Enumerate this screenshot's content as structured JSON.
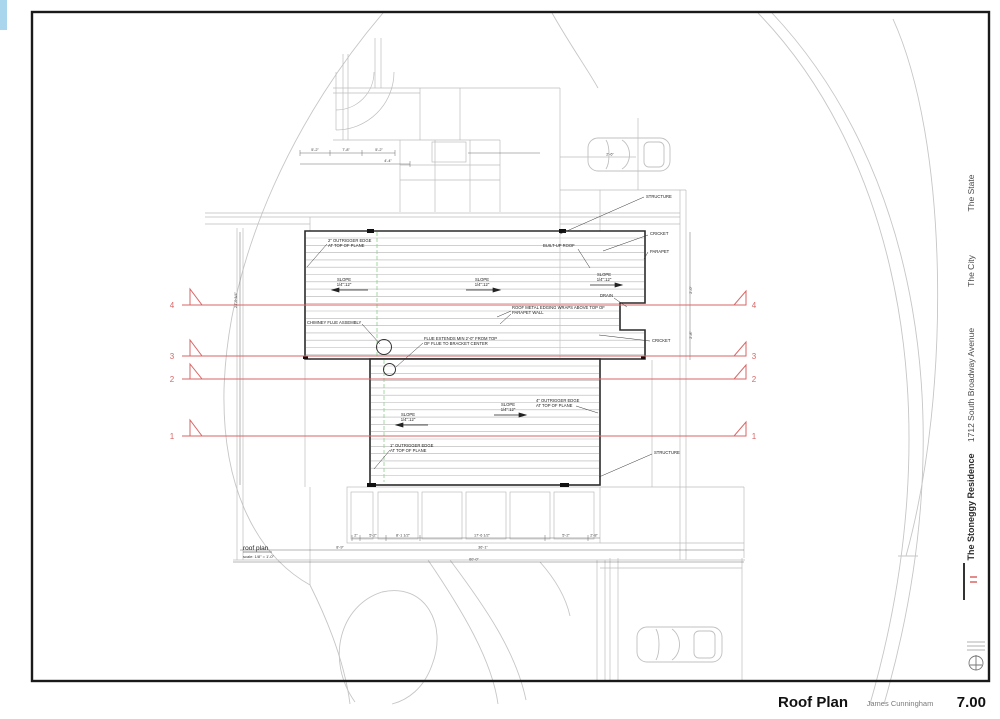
{
  "sheet": {
    "title": "Roof Plan",
    "author": "James Cunningham",
    "number": "7.00"
  },
  "title_block": {
    "state": "The State",
    "city": "The City",
    "address": "1712 South Broadway Avenue",
    "project": "The Stoneggy Residence"
  },
  "plan": {
    "view_title": "roof plan",
    "view_scale": "scale: 1/8\" = 1'-0\"",
    "section_numbers": [
      "1",
      "2",
      "3",
      "4"
    ],
    "labels": {
      "structure": "STRUCTURE",
      "cricket": "CRICKET",
      "parapet": "PARAPET",
      "built_up_roof": "BUILT-UP ROOF",
      "drain": "DRAIN",
      "slope": "SLOPE",
      "slope_ratio": "1/4\":12\"",
      "chimney": "CHIMNEY FLUE ASSEMBLY",
      "flue_note_1": "FLUE EXTENDS MIN 2'-0\" FROM TOP",
      "flue_note_2": "OF FLUE TO BRACKET CENTER",
      "metal_note_1": "ROOF METAL EDGING WRAPS ABOVE TOP OF",
      "metal_note_2": "PARAPET WALL",
      "edge_note_top_1": "2\" OUTRIGGER EDGE",
      "edge_note_right_1": "4\" OUTRIGGER EDGE",
      "edge_note_bottom_1": "1\" OUTRIGGER EDGE",
      "edge_note_line2": "AT TOP OF PLANE"
    },
    "dims": {
      "top": [
        "5'-2\"",
        "7'-8\"",
        "5'-2\"",
        "4'-4\""
      ],
      "bottom_row1": [
        "2\"",
        "5'-2\"",
        "8'-1 1/2\"",
        "17'-6 1/2\"",
        "5'-2\"",
        "2'-8\""
      ],
      "bottom_row2": [
        "8'-9\"",
        "36'-1\""
      ],
      "bottom_row3": [
        "60'-0\""
      ],
      "left_vertical": "24'-0 3/4\"",
      "right_vertical": [
        "2'-0\"",
        "2'-8\""
      ],
      "car_dim": "2'-6\""
    }
  },
  "colors": {
    "section_red": "#d96666",
    "ink": "#222222",
    "underlay_gray": "#bdbdbd",
    "site_gray": "#c6c6c6",
    "joist_gray": "#b3b3b3",
    "green_guide": "#8fcf8f",
    "corner_strip_blue": "#a9d6ec"
  }
}
